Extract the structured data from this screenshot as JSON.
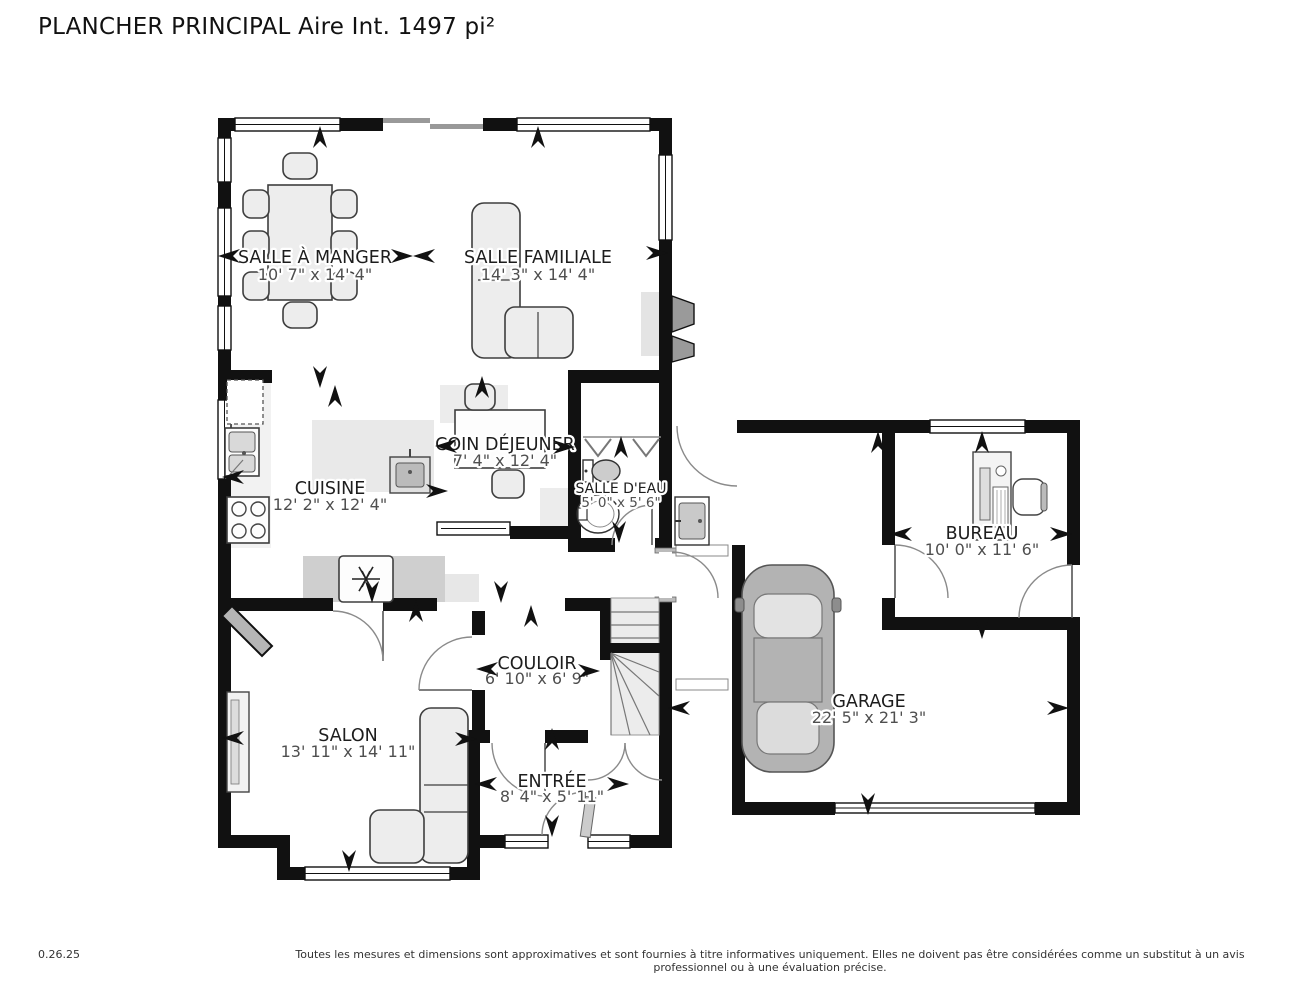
{
  "title": "PLANCHER PRINCIPAL Aire Int. 1497 pi²",
  "footer": {
    "version": "0.26.25",
    "disclaimer": "Toutes les mesures et dimensions sont approximatives et sont fournies à titre informatives uniquement. Elles ne doivent pas être considérées comme un substitut à un avis professionnel ou à une évaluation précise."
  },
  "colors": {
    "wall": "#111111",
    "furniture_fill": "#ededed",
    "deck_line": "#999999"
  },
  "rooms": [
    {
      "id": "salle-a-manger",
      "name": "SALLE À MANGER",
      "dims": "10' 7\" x 14' 4\""
    },
    {
      "id": "salle-familiale",
      "name": "SALLE FAMILIALE",
      "dims": "14' 3\" x 14' 4\""
    },
    {
      "id": "coin-dejeuner",
      "name": "COIN DÉJEUNER",
      "dims": "7' 4\" x 12' 4\""
    },
    {
      "id": "cuisine",
      "name": "CUISINE",
      "dims": "12' 2\" x 12' 4\""
    },
    {
      "id": "salle-deau",
      "name": "SALLE D'EAU",
      "dims": "5' 0\" x 5' 6\""
    },
    {
      "id": "couloir",
      "name": "COULOIR",
      "dims": "6' 10\" x 6' 9\""
    },
    {
      "id": "salon",
      "name": "SALON",
      "dims": "13' 11\" x 14' 11\""
    },
    {
      "id": "entree",
      "name": "ENTRÉE",
      "dims": "8' 4\" x 5' 11\""
    },
    {
      "id": "garage",
      "name": "GARAGE",
      "dims": "22' 5\" x 21' 3\""
    },
    {
      "id": "bureau",
      "name": "BUREAU",
      "dims": "10' 0\" x 11' 6\""
    }
  ],
  "measure_arrows": [
    [
      229,
      256,
      180
    ],
    [
      402,
      256,
      0
    ],
    [
      424,
      256,
      180
    ],
    [
      657,
      253,
      0
    ],
    [
      320,
      137,
      -90
    ],
    [
      538,
      137,
      -90
    ],
    [
      320,
      377,
      90
    ],
    [
      335,
      396,
      -90
    ],
    [
      233,
      477,
      180
    ],
    [
      437,
      491,
      0
    ],
    [
      482,
      387,
      -90
    ],
    [
      446,
      446,
      180
    ],
    [
      564,
      447,
      0
    ],
    [
      621,
      447,
      -90
    ],
    [
      619,
      532,
      90
    ],
    [
      372,
      592,
      90
    ],
    [
      416,
      611,
      -90
    ],
    [
      501,
      592,
      90
    ],
    [
      531,
      616,
      -90
    ],
    [
      487,
      669,
      180
    ],
    [
      589,
      671,
      0
    ],
    [
      233,
      738,
      180
    ],
    [
      466,
      739,
      0
    ],
    [
      349,
      861,
      90
    ],
    [
      552,
      739,
      -90
    ],
    [
      486,
      784,
      180
    ],
    [
      618,
      784,
      0
    ],
    [
      552,
      826,
      90
    ],
    [
      679,
      708,
      180
    ],
    [
      1058,
      708,
      0
    ],
    [
      878,
      442,
      -90
    ],
    [
      868,
      804,
      90
    ],
    [
      982,
      442,
      -90
    ],
    [
      901,
      534,
      180
    ],
    [
      1061,
      534,
      0
    ],
    [
      982,
      628,
      90
    ]
  ]
}
